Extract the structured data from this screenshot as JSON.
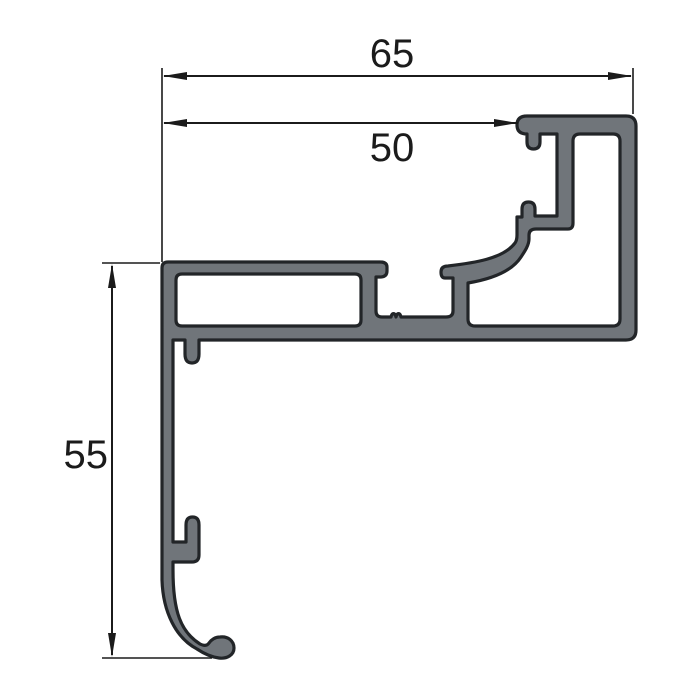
{
  "diagram": {
    "type": "technical-drawing",
    "subject": "aluminium-profile-cross-section",
    "colors": {
      "background": "#ffffff",
      "profile_fill": "#70757a",
      "profile_outline": "#222528",
      "dimension": "#1b1b1b"
    },
    "profile": {
      "path_combined": "M 527,134 Q 517,134 517,125 Q 517,116 527,116 H 626 Q 636,116 636,126 V 330 Q 636,340 626,340 H 199 V 354 Q 199,363 192,363 Q 185,363 185,354 V 340 H 173 V 542 H 186 V 525 Q 186,517 192.5,517 Q 199,517 199,525 V 555 Q 199,562 192,562 H 173 V 570 C 173,612 181,632 200,644 C 204,646 207,646 209,643 C 211,640 215,637 220,637 C 228,636 234,641 234,648 C 234,655 227,659 219,658 C 210,657 203,653 197,649 C 176,638 163,612 162,580 V 268 Q 162,262 168,262 H 380 Q 387,262 387,267 V 271 Q 387,277 380,277 H 376 V 311 Q 376,317 382,317 H 391 C 392,312.5 395,312.5 396,317 C 397,312.5 400,312.5 401,317 H 446 Q 453,317 453,311 V 278 H 445 Q 441,278 441,272 Q 441,266 448,266 C 473,263 503,259 515,243 C 516.5,241 517,238 517,235 V 217 H 522 V 209 Q 522,202 528.5,202 Q 535,202 535,209 V 216 H 557 V 134 H 540 V 142 Q 540,149 533.5,149 Q 527,149 527,142 V 134 Z M 176,280 Q 176,274 182,274 H 355 Q 361,274 361,280 V 320 Q 361,326 355,326 H 182 Q 176,326 176,320 Z M 468,283 C 492,279 512,271 521,257 C 525,251 529,245 529,239 V 235 Q 529,229 536,229 H 568 Q 573,229 573,223 V 141 Q 573,134 580,134 H 613 Q 620,134 620,141 V 319 Q 620,326 613,326 H 475 Q 468,326 468,319 Z"
    },
    "dimensions": [
      {
        "label": "65",
        "value": 65,
        "orientation": "horizontal",
        "line_d": "M164 76 H631",
        "ext_left_d": "M162 68 V262",
        "ext_right_d": "M633 68 V114",
        "arrow_left_points": "163,76 187,72 187,80",
        "arrow_right_points": "632,76 608,72 608,80",
        "label_x": 392,
        "label_y": 67,
        "label_anchor": "middle"
      },
      {
        "label": "50",
        "value": 50,
        "orientation": "horizontal",
        "line_d": "M164 123 H518",
        "arrow_left_points": "163,123 187,119 187,127",
        "arrow_right_points": "518,123 494,119 494,127",
        "label_x": 392,
        "label_y": 161,
        "label_anchor": "middle"
      },
      {
        "label": "55",
        "value": 55,
        "orientation": "vertical",
        "line_d": "M112 266 V655",
        "ext_top_d": "M102 263 H160",
        "ext_bottom_d": "M102 658 H212",
        "arrow_up_points": "112,264 108,288 116,288",
        "arrow_down_points": "112,657 108,633 116,633",
        "label_x": 108,
        "label_y": 468,
        "label_anchor": "end"
      }
    ]
  }
}
